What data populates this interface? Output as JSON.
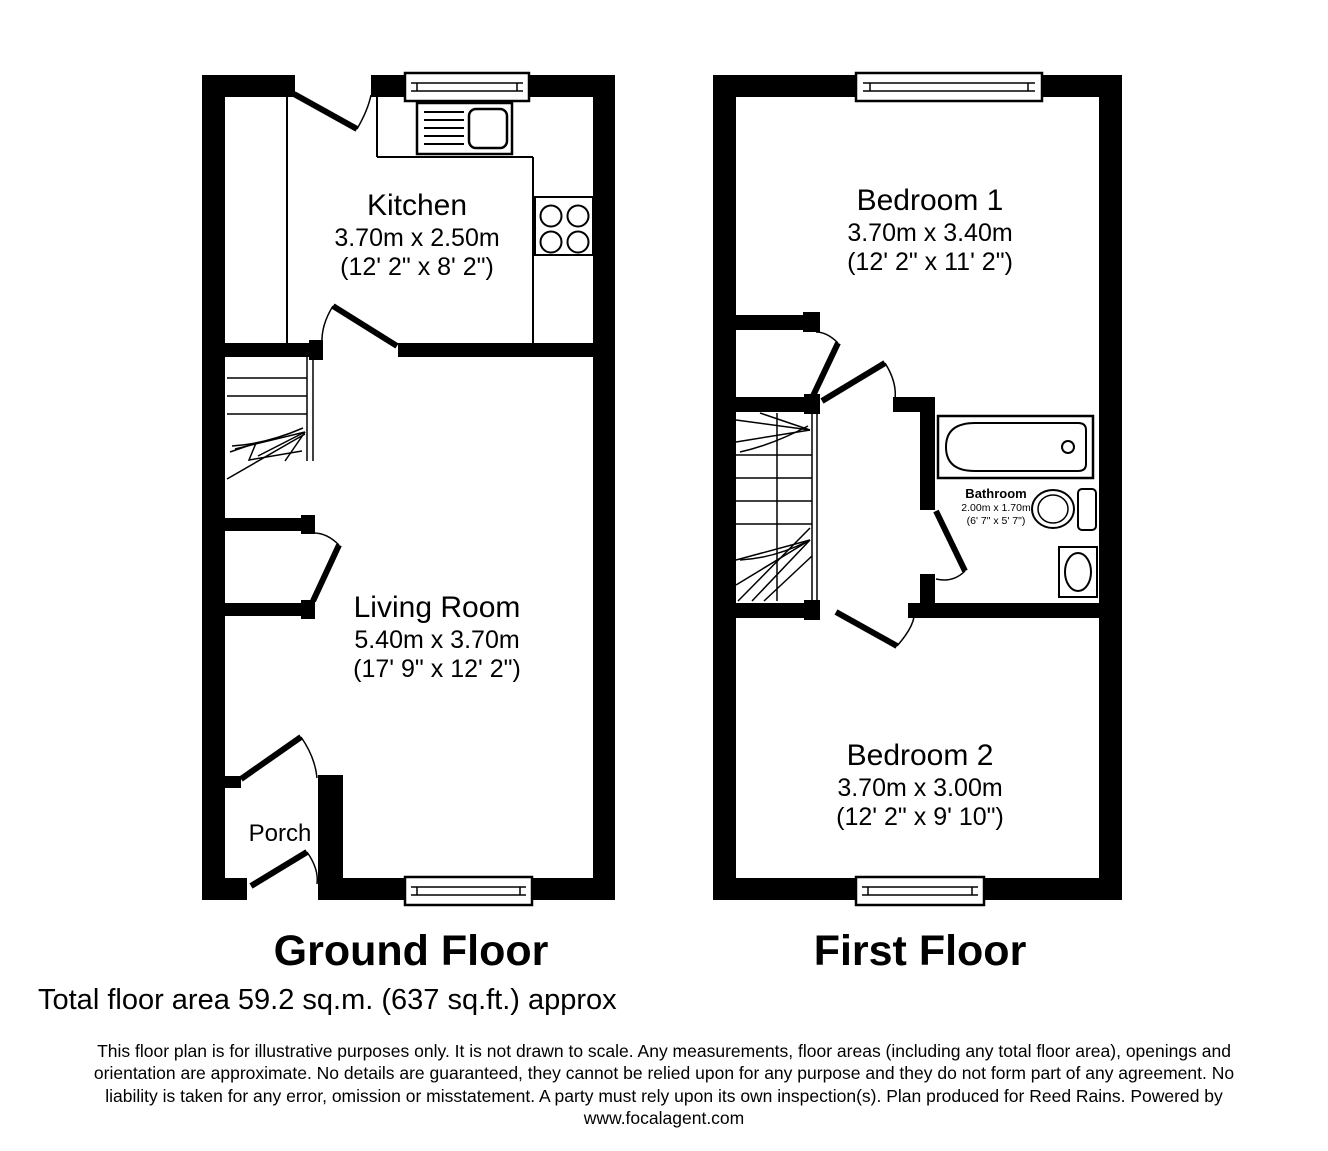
{
  "ground_floor": {
    "title": "Ground Floor",
    "rooms": {
      "kitchen": {
        "name": "Kitchen",
        "size_metric": "3.70m x 2.50m",
        "size_imperial": "(12' 2\" x 8' 2\")"
      },
      "living_room": {
        "name": "Living Room",
        "size_metric": "5.40m x 3.70m",
        "size_imperial": "(17' 9\" x 12' 2\")"
      },
      "porch": {
        "name": "Porch"
      }
    }
  },
  "first_floor": {
    "title": "First Floor",
    "rooms": {
      "bedroom_1": {
        "name": "Bedroom 1",
        "size_metric": "3.70m x 3.40m",
        "size_imperial": "(12' 2\" x 11' 2\")"
      },
      "bedroom_2": {
        "name": "Bedroom 2",
        "size_metric": "3.70m x 3.00m",
        "size_imperial": "(12' 2\" x 9' 10\")"
      },
      "bathroom": {
        "name": "Bathroom",
        "size_metric": "2.00m x 1.70m",
        "size_imperial": "(6' 7\" x 5' 7\")"
      }
    }
  },
  "footer": {
    "total_area": "Total floor area 59.2 sq.m. (637 sq.ft.) approx",
    "disclaimer_lines": [
      "This floor plan is for illustrative purposes only. It is not drawn to scale. Any measurements, floor areas (including any total floor area), openings and",
      "orientation are approximate. No details are guaranteed, they cannot be relied upon for any purpose and they do not form part of any agreement. No",
      "liability is taken for any error, omission or misstatement. A party must rely upon its own inspection(s). Plan produced for Reed Rains. Powered by",
      "www.focalagent.com"
    ]
  },
  "colors": {
    "wall": "#000000",
    "background": "#ffffff",
    "text": "#000000"
  }
}
